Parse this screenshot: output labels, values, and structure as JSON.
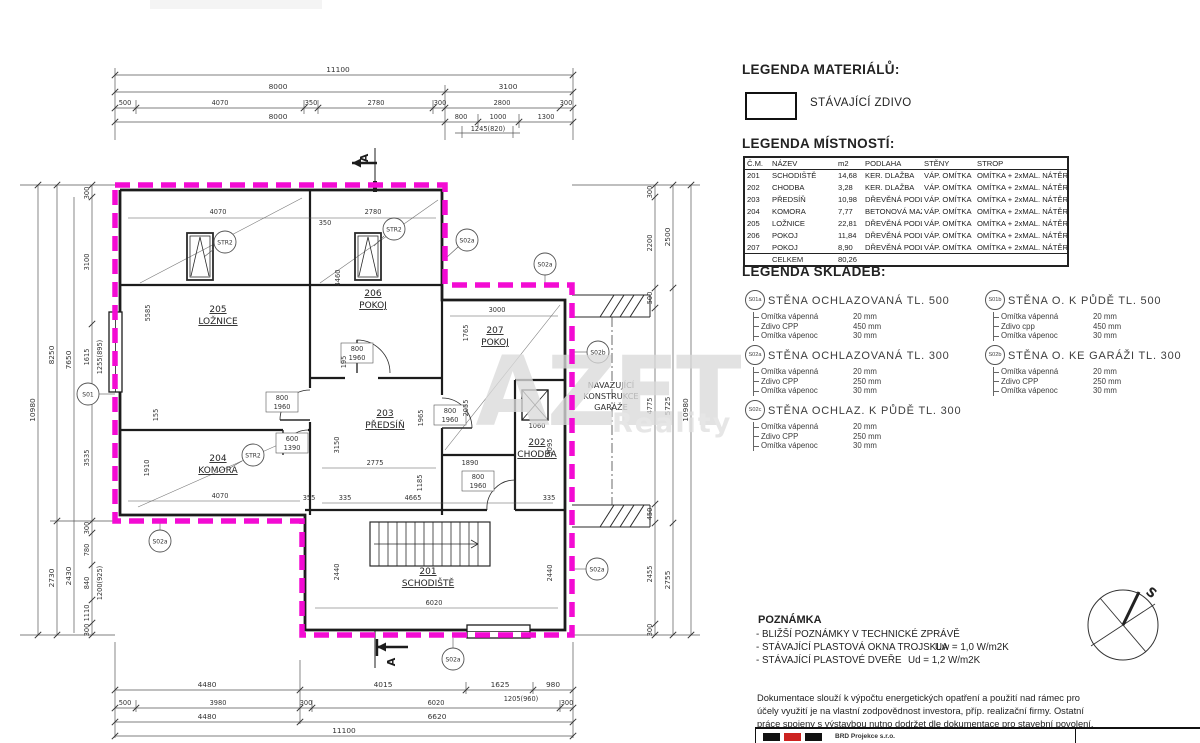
{
  "colors": {
    "outline_magenta": "#f30bd3",
    "line": "#2a2a2a",
    "watermark": "#dadada",
    "logo_red": "#cc2220"
  },
  "watermark": {
    "big": "AZET",
    "small": "Reality"
  },
  "legend_materials": {
    "title": "LEGENDA MATERIÁLŮ:",
    "item_label": "STÁVAJÍCÍ ZDIVO"
  },
  "legend_rooms": {
    "title": "LEGENDA MÍSTNOSTÍ:",
    "columns": [
      "Č.M.",
      "NÁZEV",
      "m2",
      "PODLAHA",
      "STĚNY",
      "STROP"
    ],
    "rows": [
      [
        "201",
        "SCHODIŠTĚ",
        "14,68",
        "KER. DLAŽBA",
        "VÁP. OMÍTKA",
        "OMÍTKA + 2xMAL. NÁTĚR"
      ],
      [
        "202",
        "CHODBA",
        "3,28",
        "KER. DLAŽBA",
        "VÁP. OMÍTKA",
        "OMÍTKA + 2xMAL. NÁTĚR"
      ],
      [
        "203",
        "PŘEDSÍŇ",
        "10,98",
        "DŘEVĚNÁ PODLA",
        "VÁP. OMÍTKA",
        "OMÍTKA + 2xMAL. NÁTĚR"
      ],
      [
        "204",
        "KOMORA",
        "7,77",
        "BETONOVÁ MAZ.",
        "VÁP. OMÍTKA",
        "OMÍTKA + 2xMAL. NÁTĚR"
      ],
      [
        "205",
        "LOŽNICE",
        "22,81",
        "DŘEVĚNÁ PODLA",
        "VÁP. OMÍTKA",
        "OMÍTKA + 2xMAL. NÁTĚR"
      ],
      [
        "206",
        "POKOJ",
        "11,84",
        "DŘEVĚNÁ PODLA",
        "VÁP. OMÍTKA",
        "OMÍTKA + 2xMAL. NÁTĚR"
      ],
      [
        "207",
        "POKOJ",
        "8,90",
        "DŘEVĚNÁ PODLA",
        "VÁP. OMÍTKA",
        "OMÍTKA + 2xMAL. NÁTĚR"
      ]
    ],
    "total_label": "CELKEM",
    "total_value": "80,26"
  },
  "legend_assemblies": {
    "title": "LEGENDA SKLADEB:",
    "items": [
      {
        "code": "S01a",
        "name": "STĚNA OCHLAZOVANÁ TL. 500",
        "layers": [
          [
            "Omítka vápenná",
            "20 mm"
          ],
          [
            "Zdivo CPP",
            "450 mm"
          ],
          [
            "Omítka vápenoc",
            "30 mm"
          ]
        ]
      },
      {
        "code": "S01b",
        "name": "STĚNA O. K PŮDĚ TL. 500",
        "layers": [
          [
            "Omítka vápenná",
            "20 mm"
          ],
          [
            "Zdivo cpp",
            "450 mm"
          ],
          [
            "Omítka vápenoc",
            "30 mm"
          ]
        ]
      },
      {
        "code": "S02a",
        "name": "STĚNA OCHLAZOVANÁ TL. 300",
        "layers": [
          [
            "Omítka vápenná",
            "20 mm"
          ],
          [
            "Zdivo CPP",
            "250 mm"
          ],
          [
            "Omítka vápenoc",
            "30 mm"
          ]
        ]
      },
      {
        "code": "S02b",
        "name": "STĚNA O. KE GARÁŽI TL. 300",
        "layers": [
          [
            "Omítka vápenná",
            "20 mm"
          ],
          [
            "Zdivo CPP",
            "250 mm"
          ],
          [
            "Omítka vápenoc",
            "30 mm"
          ]
        ]
      },
      {
        "code": "S02c",
        "name": "STĚNA OCHLAZ. K PŮDĚ TL. 300",
        "layers": [
          [
            "Omítka vápenná",
            "20 mm"
          ],
          [
            "Zdivo CPP",
            "250 mm"
          ],
          [
            "Omítka vápenoc",
            "30 mm"
          ]
        ]
      }
    ]
  },
  "note": {
    "title": "POZNÁMKA",
    "line1": "- BLIŽŠÍ POZNÁMKY V TECHNICKÉ ZPRÁVĚ",
    "line2": "- STÁVAJÍCÍ PLASTOVÁ OKNA TROJSKLA",
    "line2_value": "Uw = 1,0 W/m2K",
    "line3": "- STÁVAJÍCÍ PLASTOVÉ DVEŘE",
    "line3_value": "Ud = 1,2 W/m2K"
  },
  "disclaimer": {
    "l1": "Dokumentace slouží k výpočtu energetických opatření a použití nad rámec pro",
    "l2": "účely využití je na vlastní zodpovědnost investora, příp. realizační firmy. Ostatní",
    "l3": "práce spojeny s výstavbou nutno dodržet dle dokumentace pro stavební povolení."
  },
  "compass": {
    "label": "S"
  },
  "titleblock": {
    "company": "BRD Projekce s.r.o."
  },
  "plan": {
    "section_label": "A",
    "garage_note": {
      "l1": "NAVAZUJÍCÍ",
      "l2": "KONSTRUKCE",
      "l3": "GARÁŽE"
    },
    "markers": {
      "str2": "STR2",
      "s01": "S01",
      "s02a": "S02a",
      "s02b": "S02b"
    },
    "rooms": [
      {
        "num": "205",
        "name": "LOŽNICE"
      },
      {
        "num": "206",
        "name": "POKOJ"
      },
      {
        "num": "207",
        "name": "POKOJ"
      },
      {
        "num": "203",
        "name": "PŘEDSÍŇ"
      },
      {
        "num": "204",
        "name": "KOMORA"
      },
      {
        "num": "202",
        "name": "CHODBA"
      },
      {
        "num": "201",
        "name": "SCHODIŠTĚ"
      }
    ],
    "dims_top": [
      "11100",
      "8000",
      "3100",
      "500",
      "4070",
      "350",
      "2780",
      "300",
      "2800",
      "300",
      "8000",
      "800",
      "1000",
      "1300",
      "1245(820)"
    ],
    "dims_bottom": [
      "4480",
      "4015",
      "1625",
      "980",
      "500",
      "3980",
      "300",
      "6020",
      "1205(960)",
      "300",
      "4480",
      "6620",
      "11100"
    ],
    "dims_left": [
      "300",
      "3100",
      "1615",
      "1255(895)",
      "3535",
      "300",
      "780",
      "840",
      "1200(925)",
      "1110",
      "300",
      "8250",
      "2730",
      "7650",
      "2430",
      "10980"
    ],
    "dims_right": [
      "300",
      "2200",
      "500",
      "4775",
      "450",
      "2455",
      "300",
      "2500",
      "5725",
      "2755",
      "10980"
    ],
    "dims_inner": [
      "4070",
      "2780",
      "350",
      "5585",
      "4460",
      "195",
      "3000",
      "1765",
      "2055",
      "1965",
      "3150",
      "2775",
      "1890",
      "1185",
      "4665",
      "355",
      "335",
      "1060",
      "3095",
      "155",
      "1910",
      "4070",
      "2440",
      "6020"
    ],
    "door_labels": [
      [
        "800",
        "1960"
      ],
      [
        "600",
        "1390"
      ]
    ]
  }
}
